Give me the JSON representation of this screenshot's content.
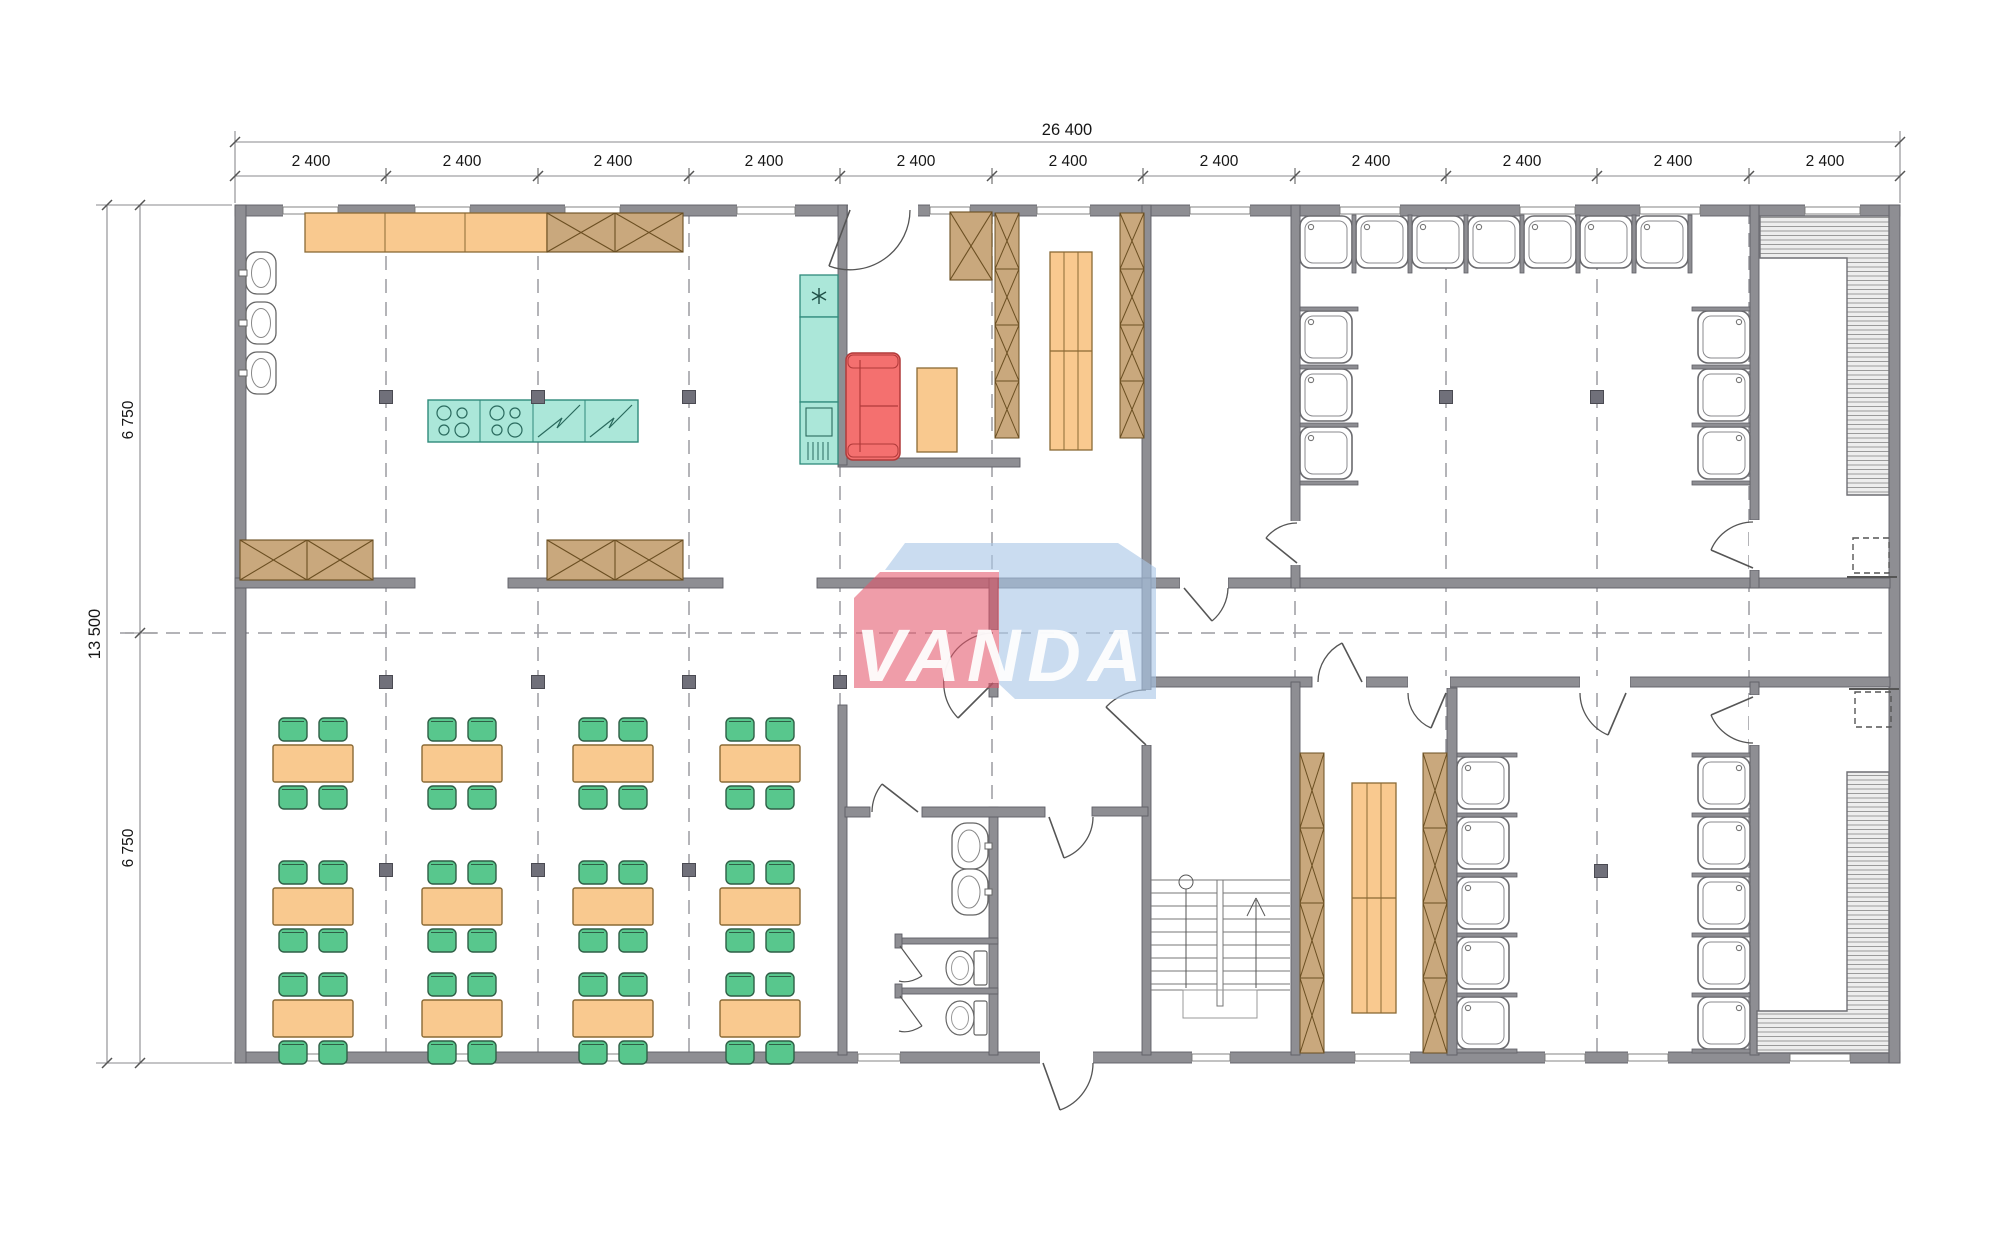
{
  "watermark": {
    "text": "VANDA",
    "red": "#E4566B",
    "blue": "#A9C7E6"
  },
  "dimensions": {
    "total_width": "26 400",
    "total_height": "13 500",
    "upper_half": "6 750",
    "lower_half": "6 750",
    "bays": [
      "2 400",
      "2 400",
      "2 400",
      "2 400",
      "2 400",
      "2 400",
      "2 400",
      "2 400",
      "2 400",
      "2 400",
      "2 400"
    ]
  },
  "colors": {
    "wall": "#8E8E93",
    "furniture_orange": "#F9C98F",
    "cabinet_tan": "#C9A87D",
    "appliance_teal": "#ABE7D9",
    "sofa_red": "#F4706F",
    "chair_green": "#58C78D",
    "column": "#70707A",
    "bench_fill": "#EDEDED"
  },
  "counts": {
    "dining_tables": 12,
    "dining_chairs": 48,
    "shower_stalls": 23,
    "kitchen_wall_sinks": 3,
    "bathroom_sinks": 2,
    "toilets": 2,
    "saunas": 2,
    "staircases": 1
  }
}
